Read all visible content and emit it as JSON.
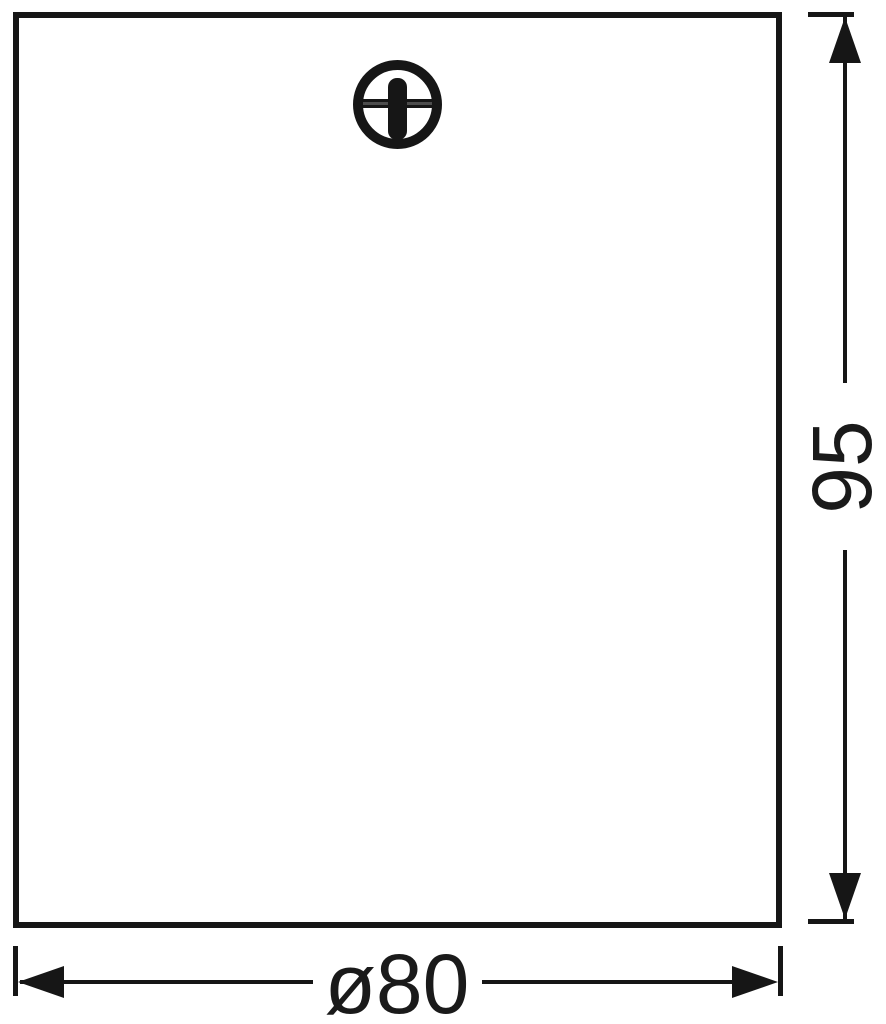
{
  "drawing": {
    "background_color": "#ffffff",
    "line_color": "#161616",
    "product": {
      "outline_shape": "rectangle",
      "screw_icon": "phillips-screw-head"
    },
    "dimensions": {
      "height": {
        "label": "95",
        "orientation": "vertical"
      },
      "diameter": {
        "label": "ø80",
        "orientation": "horizontal"
      }
    }
  }
}
